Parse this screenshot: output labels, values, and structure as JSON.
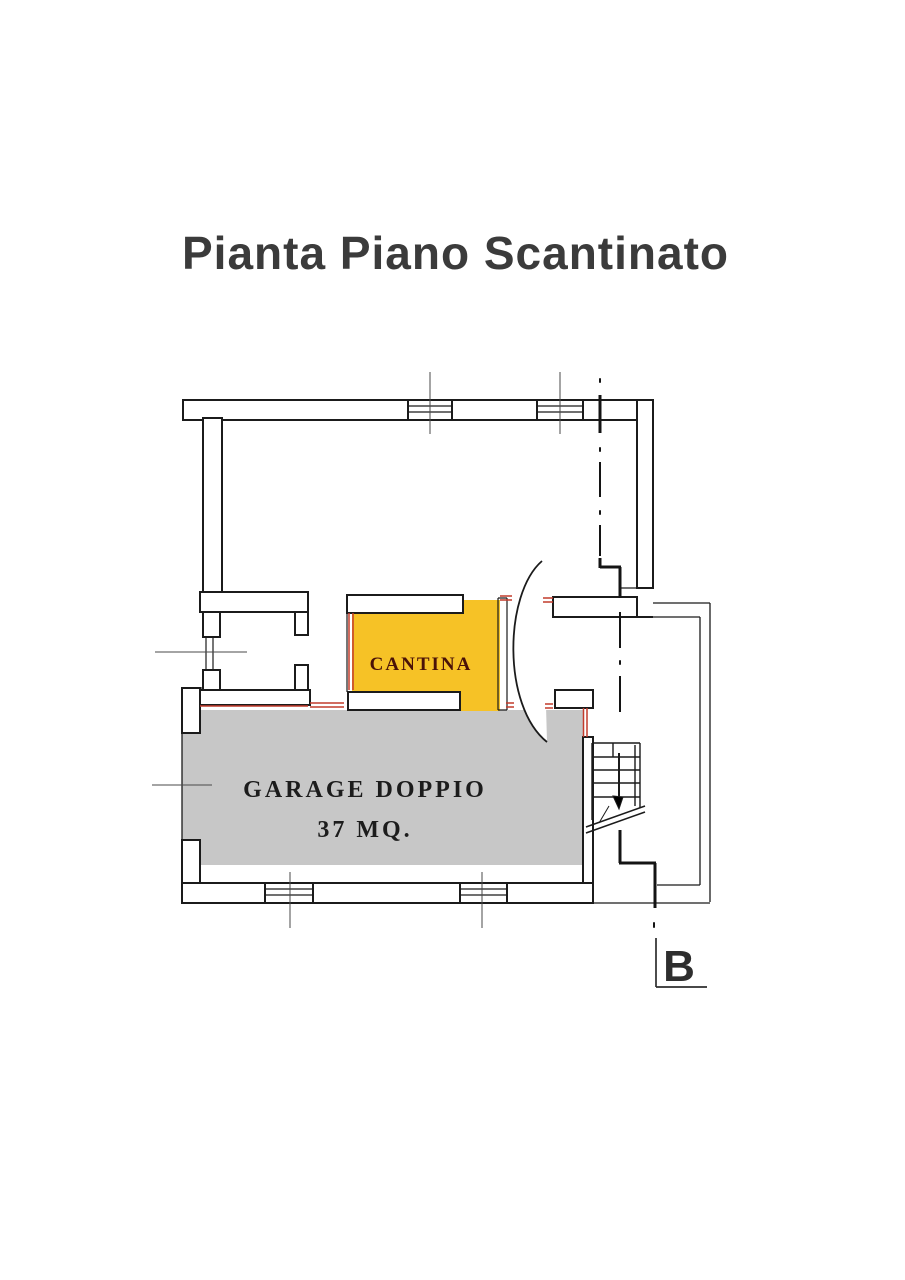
{
  "title": "Pianta Piano Scantinato",
  "title_color": "#3b3b3b",
  "plan": {
    "wall_color": "#1b1b1b",
    "wall_fill": "#ffffff",
    "accent_color": "#c23b2c",
    "tick_color": "#4a4a4a",
    "section_line_color": "#141414",
    "rooms": [
      {
        "id": "cantina",
        "label": "CANTINA",
        "fill": "#f6c226",
        "label_color": "#4a1208"
      },
      {
        "id": "garage",
        "label": "GARAGE DOPPIO",
        "area_label": "37 MQ.",
        "fill": "#c7c7c7",
        "label_color": "#1c1c1c"
      }
    ],
    "section_marker": {
      "label": "B",
      "color": "#2e2e2e"
    }
  }
}
